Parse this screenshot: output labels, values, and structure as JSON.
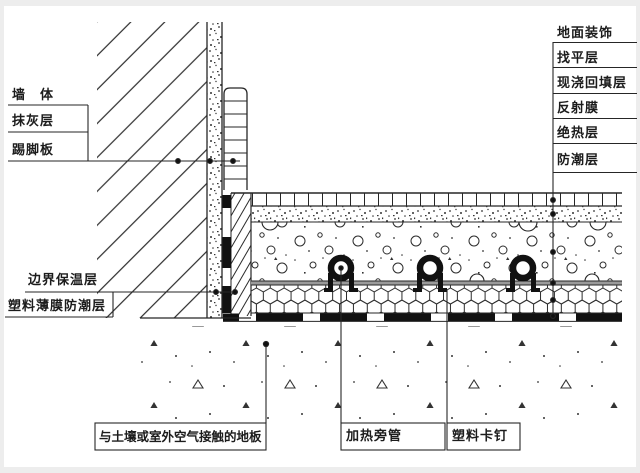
{
  "labels": {
    "layer_stack_right": [
      "地面装饰",
      "找平层",
      "现浇回填层",
      "反射膜",
      "绝热层",
      "防潮层"
    ],
    "wall_stack_left": [
      "墙　体",
      "抹灰层",
      "踢脚板"
    ],
    "edge_stack_left": [
      "边界保温层",
      "塑料薄膜防潮层"
    ],
    "bottom_left": "与土壤或室外空气接触的地板",
    "bottom_center": "加热旁管",
    "bottom_right": "塑料卡钉"
  },
  "colors": {
    "line": "#262626",
    "film_gray": "#9a9a9a",
    "paper": "#ffffff",
    "page_bg": "#ededed"
  }
}
